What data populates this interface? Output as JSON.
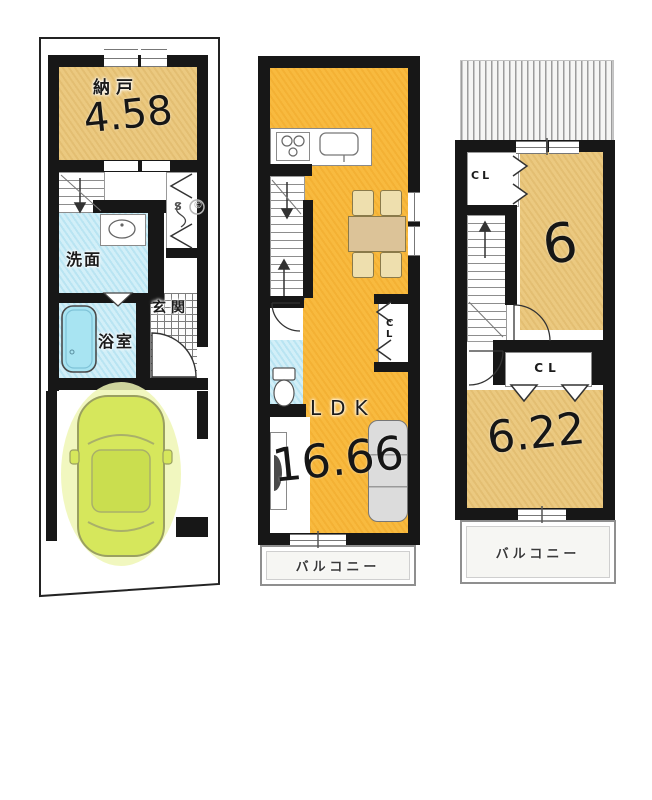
{
  "figure": "house-floor-plan-3-stories",
  "colors": {
    "wall": "#171717",
    "tan_room": "#ebc980",
    "orange_room": "#f8ba3f",
    "blue_room": "#d2eff8",
    "bathtub": "#a8e4f2",
    "car_body": "#d6e75c",
    "car_glow": "#eef6b4",
    "balcony_fill": "#f6f6f3"
  },
  "floor1": {
    "storage_label": "納戸",
    "storage_area": "4.58",
    "washroom_label": "洗面",
    "bathroom_label": "浴室",
    "entrance_label": "玄関",
    "closet_symbol": "S",
    "copyright_mark": "©"
  },
  "floor2": {
    "room_label": "LDK",
    "room_area": "16.66",
    "closet_label": "CL",
    "balcony_label": "バルコニー"
  },
  "floor3": {
    "closet_top_label": "CL",
    "room_top_area": "6",
    "closet_mid_label": "CL",
    "room_bottom_area": "6.22",
    "balcony_label": "バルコニー"
  }
}
